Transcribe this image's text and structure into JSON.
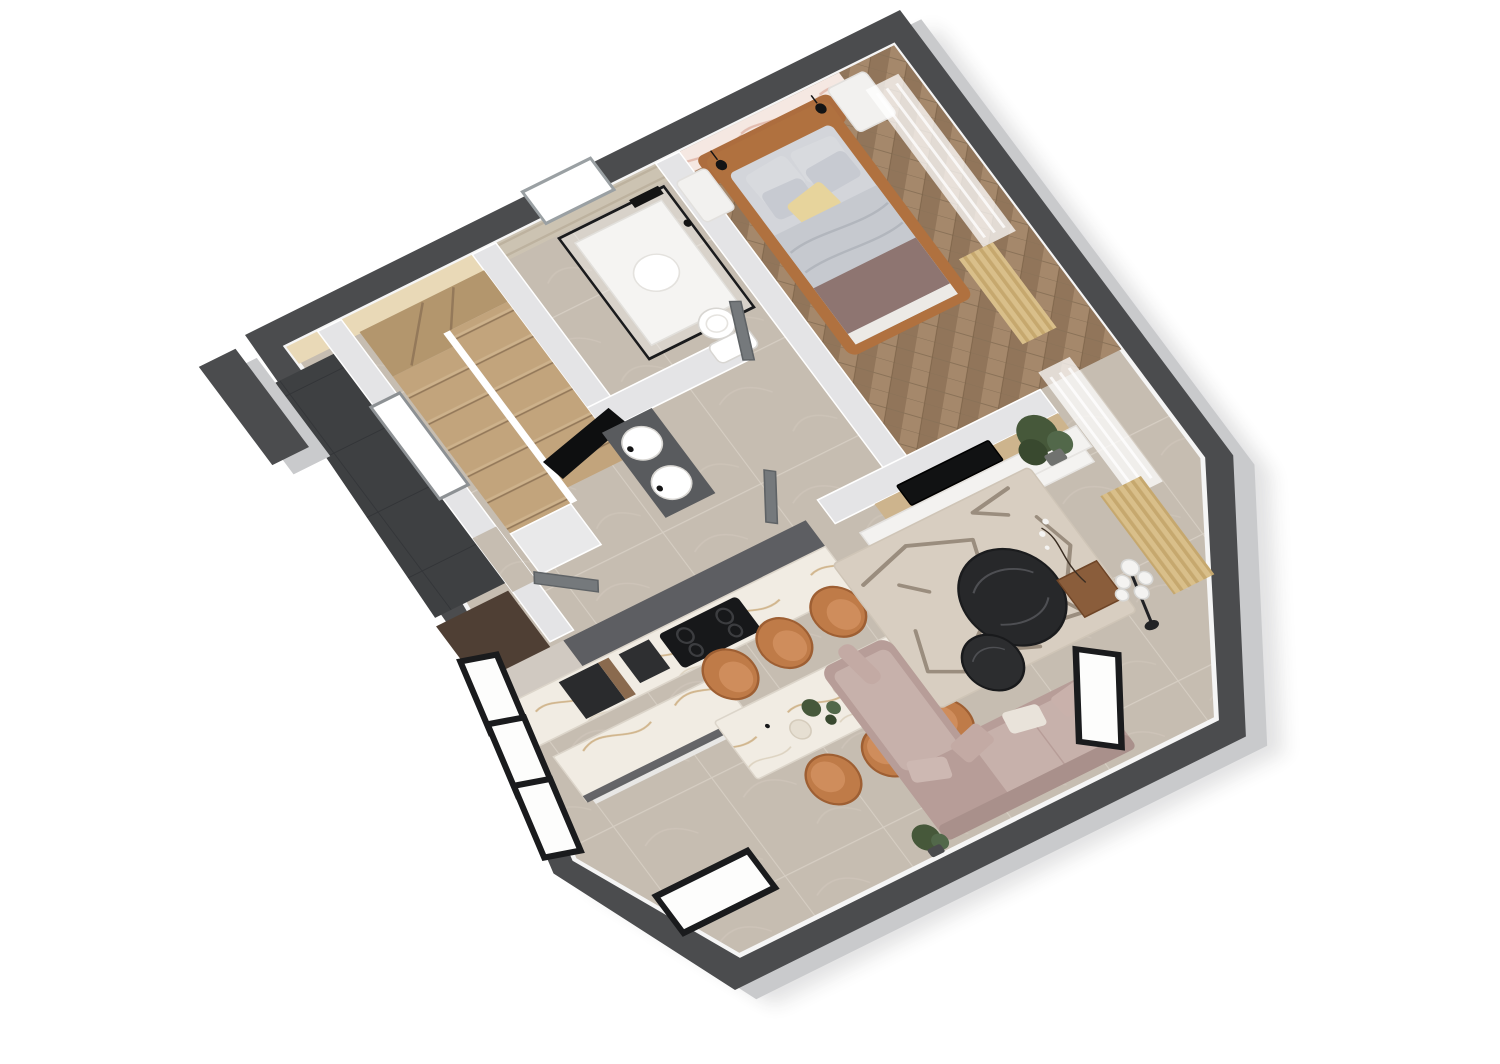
{
  "scene": {
    "type": "3d-floor-plan-render",
    "view": "isometric top-down, rotated ~26 degrees, white background",
    "rooms": [
      {
        "id": "bedroom",
        "position": "top-right",
        "floor": "herringbone-wood",
        "items": [
          "double-bed-cognac-leather-frame",
          "gray-duvet",
          "yellow-accent-pillow",
          "mauve-throw",
          "pink-marble-accent-wall",
          "two-black-wall-sconces",
          "white-nightstands",
          "sheer-curtain",
          "gold-curtain"
        ]
      },
      {
        "id": "bathroom",
        "position": "top-center",
        "floor": "greige-marble-tile",
        "items": [
          "black-frame-glass-shower",
          "white-shower-tray",
          "toilet",
          "travertine-wall",
          "window",
          "gray-door"
        ]
      },
      {
        "id": "stair-hall",
        "position": "left",
        "floor": "greige-marble-tile",
        "items": [
          "u-shaped-tan-staircase",
          "black-railing",
          "double-sink-vanity",
          "window",
          "cream-wall"
        ]
      },
      {
        "id": "entry-porch",
        "position": "far-left",
        "floor": "dark-charcoal-tile",
        "items": [
          "freestanding-pillar",
          "entry-door"
        ]
      },
      {
        "id": "kitchen-dining",
        "position": "bottom-left",
        "floor": "greige-marble-tile",
        "items": [
          "wall-counter-with-cooktop",
          "black-built-in-oven",
          "dark-upper-cabinets",
          "marble-island",
          "marble-dining-table",
          "six-tan-leather-chairs",
          "sliding-glass-doors",
          "black-framed-window",
          "plant-centerpiece"
        ]
      },
      {
        "id": "living-room",
        "position": "right",
        "floor": "greige-marble-tile",
        "items": [
          "tv-partition-wall-oak",
          "black-tv",
          "white-media-cabinet",
          "floating-shelf",
          "abstract-beige-rug",
          "two-round-black-marble-coffee-tables",
          "l-shaped-mauve-sofa",
          "globe-floor-lamp",
          "corner-plants",
          "copper-planter",
          "gold-curtain",
          "sheer-curtain",
          "chamfer-window"
        ]
      }
    ]
  },
  "colors": {
    "bg": "#ffffff",
    "wall_top": "#4b4c4e",
    "wall_side": "#c9cacc",
    "partition": "#e4e4e6",
    "floor": "#c6bdb1",
    "grout": "#d6cec3",
    "floor_vein": "#d0c7bb",
    "porch": "#3e4042",
    "porch_line": "#333538",
    "wood1": "#a5886b",
    "wood2": "#91755a",
    "cream": "#e9d9b7",
    "travertine": "#ccc3b2",
    "trav_streak": "#b9ae9a",
    "marble_pink": "#f5e8e2",
    "marble_pink_vein": "#dfb2a2",
    "stair": "#c2a47c",
    "stair_dark": "#b3966d",
    "stair_edge": "#94795a",
    "rail": "#0e0f10",
    "vanity": "#595b5e",
    "door": "#75797c",
    "door_dark": "#5f6366",
    "glass_frame": "#1a1b1d",
    "counter_marble": "#f1ece3",
    "marble_vein": "#c9a979",
    "cab_dark": "#5d5e62",
    "greige": "#d0c9c1",
    "pantry": "#4f3f34",
    "appliance": "#2a2b2d",
    "bronze": "#8a6a4e",
    "island_edge": "#55565a",
    "chair": "#bf7b48",
    "chair_dark": "#9e5f33",
    "chair_seat": "#cf8d5c",
    "tv_wood": "#cdb48d",
    "tv_black": "#111213",
    "unit_white": "#f3f2f0",
    "rug": "#d8cec1",
    "rug_line": "#8f8172",
    "coffee": "#27282a",
    "coffee_vein": "#4e4f53",
    "sofa": "#b79d98",
    "sofa_light": "#c7b1ab",
    "sofa_dark": "#a9908b",
    "pillow_white": "#e9e3da",
    "gold": "#d9bf8a",
    "gold_dark": "#c6a86e",
    "plant": "#46583a",
    "plant_dark": "#39492f",
    "plant_light": "#52684a",
    "pot": "#70726f",
    "copper": "#8a5d3b",
    "bed_frame": "#b0713f",
    "mattress": "#d3d5da",
    "duvet": "#c6c9cf",
    "duvet_line": "#b2b6bd",
    "pillow": "#d8dade",
    "pillow2": "#c7cad1",
    "yellow": "#e7d49c",
    "throw": "#8e7571",
    "nightstand": "#f2f1ef",
    "sconce": "#141415",
    "shower_tray": "#f5f4f2",
    "fixture_edge": "#d8d6d2",
    "lamp_globe": "#f4f3f1",
    "lamp_stem": "#202124"
  }
}
